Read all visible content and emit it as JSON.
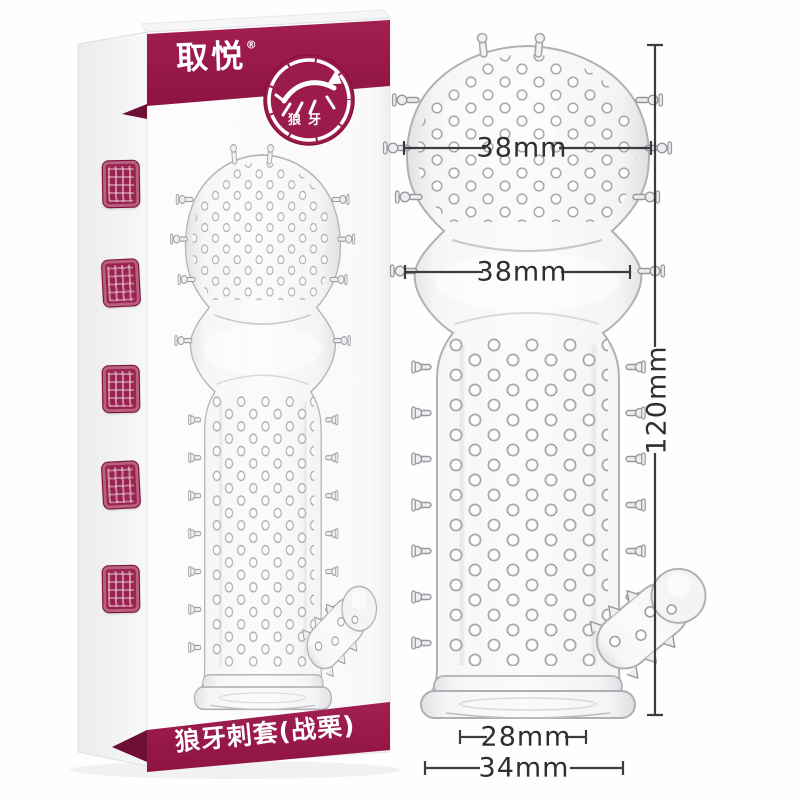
{
  "box": {
    "brand": "取悦",
    "registered_mark": "®",
    "emblem": {
      "icon": "wolf-icon",
      "label": "狼牙"
    },
    "bottom_banner_label": "狼牙刺套(战栗)",
    "side_seal_icon": "chinese-seal-stamp-icon",
    "side_seal_count": 5
  },
  "measurements": {
    "head_width": "38mm",
    "bulge_width": "38mm",
    "total_length": "120mm",
    "opening_inner_width": "28mm",
    "base_outer_width": "34mm"
  },
  "colors": {
    "brand_maroon": "#9B1B4B",
    "dimension_line": "#3C3C3F",
    "dimension_text": "#2F2F31"
  }
}
